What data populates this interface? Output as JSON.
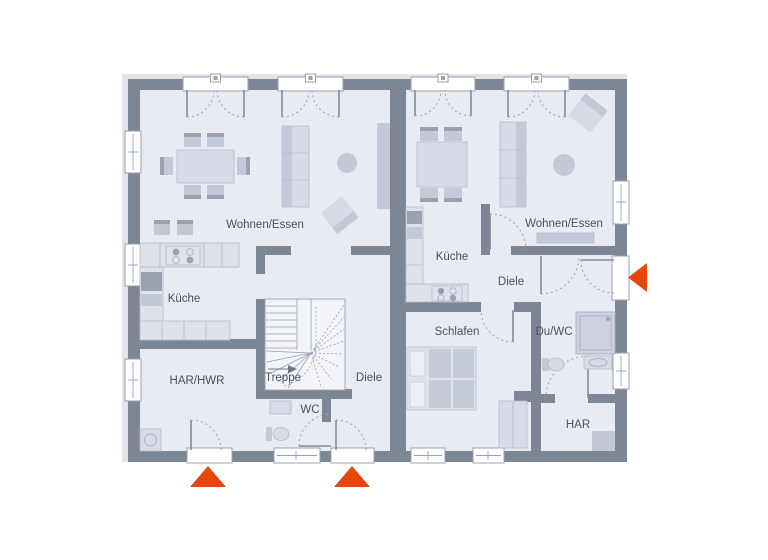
{
  "floorplan": {
    "title": "Doppelhaus Erdgeschoss Grundriss",
    "rooms": {
      "left_wohnen_essen": "Wohnen/Essen",
      "left_kueche": "Küche",
      "left_har_hwr": "HAR/HWR",
      "left_treppe": "Treppe",
      "left_diele": "Diele",
      "left_wc": "WC",
      "right_wohnen_essen": "Wohnen/Essen",
      "right_kueche": "Küche",
      "right_diele": "Diele",
      "right_schlafen": "Schlafen",
      "right_du_wc": "Du/WC",
      "right_har": "HAR"
    },
    "colors": {
      "wall": "#7d8695",
      "floor": "#e9ebf2",
      "entrance_marker": "#e5470d",
      "label": "#4a5160"
    },
    "icons": {
      "entrance_marker": "filled-triangle",
      "stair_direction": "arrow-right"
    }
  }
}
